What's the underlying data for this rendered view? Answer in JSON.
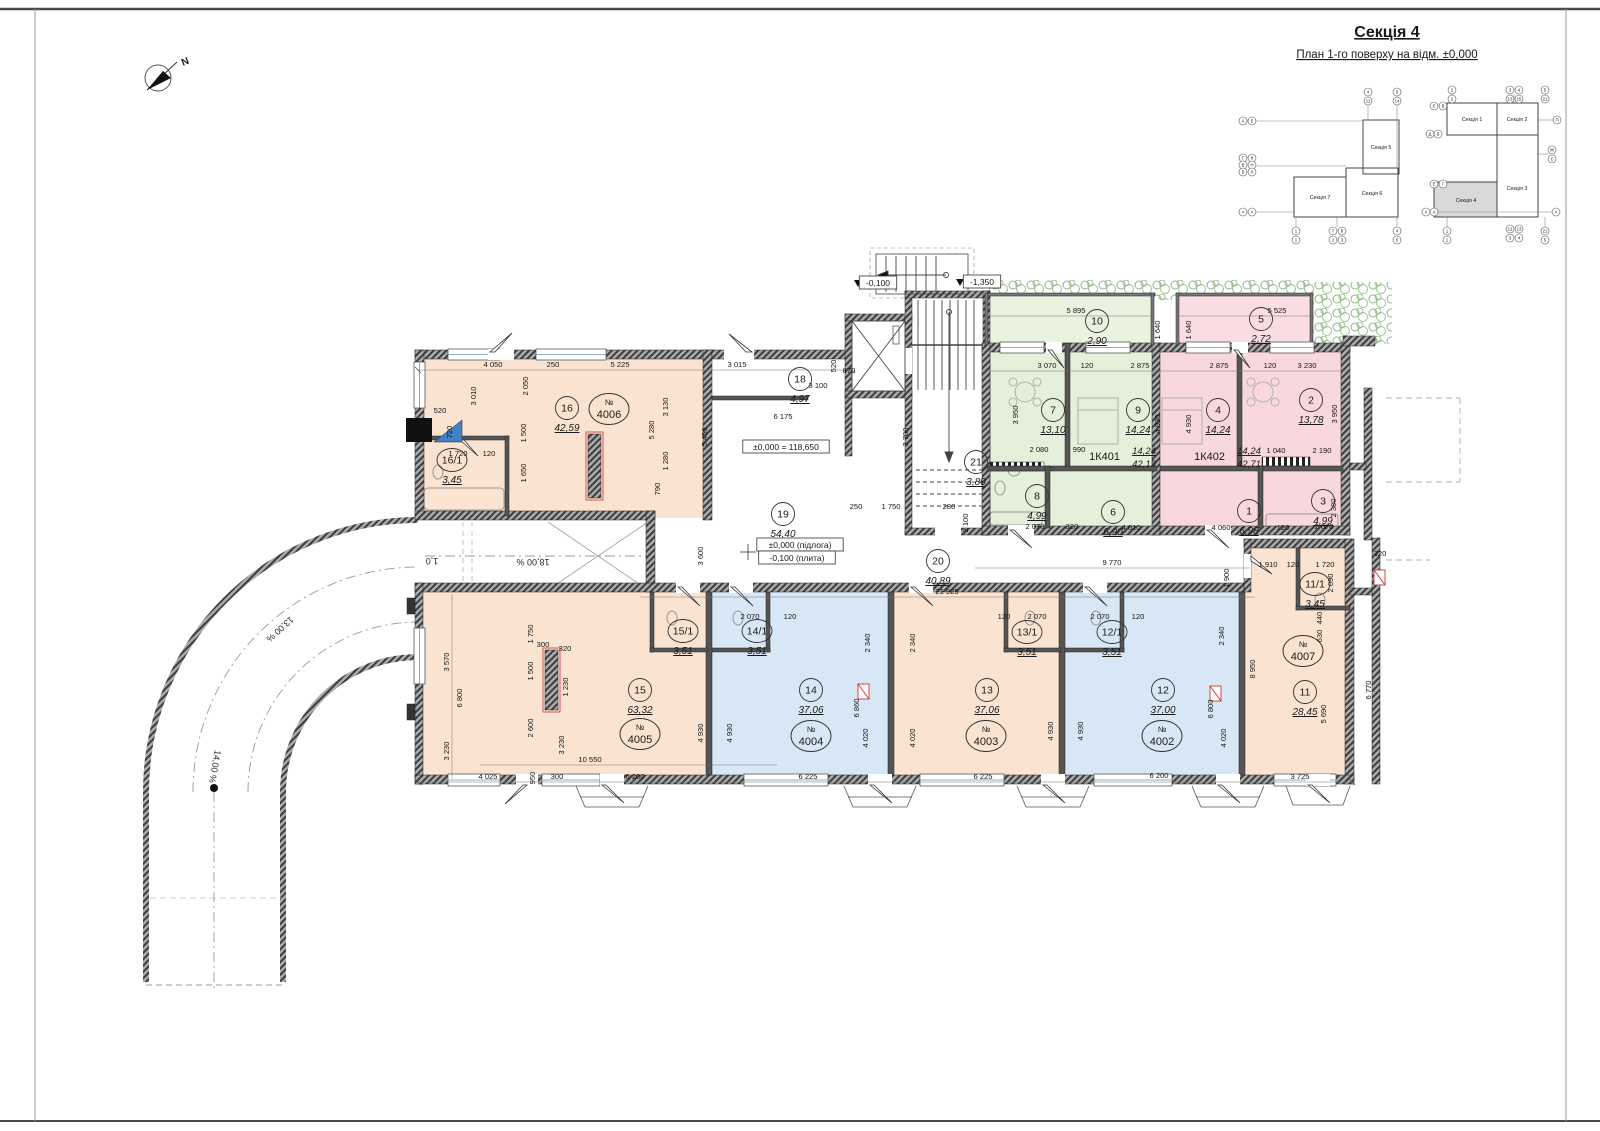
{
  "sheet": {
    "title": "Секція 4",
    "subtitle": "План 1-го поверху на відм. ±0,000"
  },
  "north": {
    "label": "N"
  },
  "key_plan": {
    "sections": [
      "Секція 5",
      "Секція 7",
      "Секція 6",
      "Секція 1",
      "Секція 2",
      "Секція 4",
      "Секція 3"
    ],
    "highlighted": "Секція 4",
    "axes": [
      [
        "А",
        1243,
        121
      ],
      [
        "Е",
        1252,
        121
      ],
      [
        "Г",
        1243,
        158
      ],
      [
        "К",
        1252,
        158
      ],
      [
        "В",
        1243,
        165
      ],
      [
        "Н",
        1252,
        165
      ],
      [
        "Б",
        1243,
        172
      ],
      [
        "Л",
        1252,
        172
      ],
      [
        "А",
        1243,
        212
      ],
      [
        "А",
        1252,
        212
      ],
      [
        "4",
        1368,
        92
      ],
      [
        "11",
        1368,
        101
      ],
      [
        "5",
        1397,
        92
      ],
      [
        "14",
        1397,
        101
      ],
      [
        "1",
        1296,
        231
      ],
      [
        "1",
        1296,
        240
      ],
      [
        "7",
        1333,
        231
      ],
      [
        "8",
        1342,
        231
      ],
      [
        "2",
        1333,
        240
      ],
      [
        "3",
        1342,
        240
      ],
      [
        "4",
        1397,
        231
      ],
      [
        "5",
        1397,
        240
      ],
      [
        "Є",
        1434,
        106
      ],
      [
        "В",
        1443,
        106
      ],
      [
        "Д",
        1430,
        134
      ],
      [
        "Б",
        1438,
        134
      ],
      [
        "Е",
        1434,
        184
      ],
      [
        "Г",
        1443,
        184
      ],
      [
        "А",
        1426,
        212
      ],
      [
        "А",
        1434,
        212
      ],
      [
        "2",
        1452,
        90
      ],
      [
        "2",
        1452,
        99
      ],
      [
        "3",
        1510,
        90
      ],
      [
        "4",
        1519,
        90
      ],
      [
        "13",
        1510,
        99
      ],
      [
        "15",
        1519,
        99
      ],
      [
        "5",
        1545,
        90
      ],
      [
        "21",
        1545,
        99
      ],
      [
        "П",
        1557,
        120
      ],
      [
        "Ж",
        1552,
        150
      ],
      [
        "Є",
        1552,
        159
      ],
      [
        "А",
        1556,
        212
      ],
      [
        "1",
        1447,
        231
      ],
      [
        "1",
        1447,
        240
      ],
      [
        "12",
        1510,
        229
      ],
      [
        "13",
        1519,
        229
      ],
      [
        "3",
        1510,
        238
      ],
      [
        "4",
        1519,
        238
      ],
      [
        "21",
        1545,
        231
      ],
      [
        "5",
        1545,
        240
      ]
    ]
  },
  "levels": [
    [
      "±0,000 = 118,650",
      786,
      447
    ],
    [
      "±0,000 (підлога)",
      800,
      545
    ],
    [
      "-0,100 (плита)",
      797,
      558
    ],
    [
      "-0,100",
      878,
      283
    ],
    [
      "-1,350",
      982,
      282
    ]
  ],
  "slopes": [
    [
      "13,00 %",
      278,
      627,
      138
    ],
    [
      "18,00 %",
      533,
      559,
      180
    ],
    [
      "1,0",
      432,
      558,
      180
    ],
    [
      "14,00 %",
      212,
      766,
      100
    ]
  ],
  "rooms": [
    [
      "16",
      "42,59",
      567,
      408
    ],
    [
      "16/1",
      "3,45",
      452,
      460
    ],
    [
      "18",
      "4,97",
      800,
      379
    ],
    [
      "19",
      "54,40",
      783,
      514
    ],
    [
      "21",
      "3,80",
      976,
      462
    ],
    [
      "20",
      "40,89",
      938,
      561
    ],
    [
      "10",
      "2,90",
      1097,
      321
    ],
    [
      "7",
      "13,10",
      1053,
      410
    ],
    [
      "9",
      "14,24",
      1138,
      410
    ],
    [
      "8",
      "4,99",
      1037,
      496
    ],
    [
      "6",
      "6,90",
      1113,
      512
    ],
    [
      "5",
      "2,72",
      1261,
      319
    ],
    [
      "4",
      "14,24",
      1218,
      410
    ],
    [
      "2",
      "13,78",
      1311,
      400
    ],
    [
      "1",
      "6,98",
      1249,
      511
    ],
    [
      "3",
      "4,99",
      1323,
      501
    ],
    [
      "15",
      "63,32",
      640,
      690
    ],
    [
      "15/1",
      "3,51",
      683,
      631
    ],
    [
      "14/1",
      "3,51",
      757,
      631
    ],
    [
      "14",
      "37,06",
      811,
      690
    ],
    [
      "13/1",
      "3,51",
      1027,
      632
    ],
    [
      "13",
      "37,06",
      987,
      690
    ],
    [
      "12/1",
      "3,51",
      1112,
      632
    ],
    [
      "12",
      "37,00",
      1163,
      690
    ],
    [
      "11/1",
      "3,45",
      1315,
      584
    ],
    [
      "11",
      "28,45",
      1305,
      692
    ]
  ],
  "units": [
    [
      "4006",
      609,
      409
    ],
    [
      "4005",
      640,
      734
    ],
    [
      "4004",
      811,
      736
    ],
    [
      "4003",
      986,
      736
    ],
    [
      "4002",
      1162,
      736
    ],
    [
      "4007",
      1303,
      651
    ]
  ],
  "apartments": [
    [
      "1К401",
      "14,24",
      "42,13",
      1120,
      460
    ],
    [
      "1К402",
      "14,24",
      "42,71",
      1225,
      460
    ]
  ],
  "dims": [
    [
      "4 050",
      493,
      367,
      0
    ],
    [
      "250",
      553,
      367,
      0
    ],
    [
      "5 225",
      620,
      367,
      0
    ],
    [
      "3 015",
      737,
      367,
      0
    ],
    [
      "3 100",
      818,
      388,
      0
    ],
    [
      "870",
      849,
      373,
      0
    ],
    [
      "520",
      836,
      366,
      -90
    ],
    [
      "6 175",
      783,
      419,
      0
    ],
    [
      "5 450",
      707,
      437,
      -90
    ],
    [
      "3 010",
      476,
      396,
      -90
    ],
    [
      "2 050",
      528,
      386,
      -90
    ],
    [
      "1 500",
      526,
      433,
      -90
    ],
    [
      "1 650",
      526,
      473,
      -90
    ],
    [
      "520",
      440,
      413,
      0
    ],
    [
      "720",
      452,
      432,
      -90
    ],
    [
      "1 720",
      458,
      456,
      0
    ],
    [
      "120",
      489,
      456,
      0
    ],
    [
      "5 280",
      654,
      430,
      -90
    ],
    [
      "3 130",
      668,
      407,
      -90
    ],
    [
      "1 280",
      668,
      461,
      -90
    ],
    [
      "790",
      660,
      489,
      -90
    ],
    [
      "3 700",
      908,
      437,
      -90
    ],
    [
      "3 600",
      703,
      556,
      -90
    ],
    [
      "250",
      856,
      509,
      0
    ],
    [
      "1 750",
      891,
      509,
      0
    ],
    [
      "280",
      949,
      509,
      0
    ],
    [
      "2 100",
      968,
      523,
      -90
    ],
    [
      "21 925",
      947,
      594,
      0
    ],
    [
      "9 770",
      1112,
      565,
      0
    ],
    [
      "1 900",
      1229,
      578,
      -90
    ],
    [
      "1 910",
      1268,
      567,
      0
    ],
    [
      "120",
      1293,
      567,
      0
    ],
    [
      "1 720",
      1325,
      567,
      0
    ],
    [
      "2 090",
      1333,
      583,
      -90
    ],
    [
      "320",
      1380,
      556,
      0
    ],
    [
      "5 895",
      1076,
      313,
      0
    ],
    [
      "1 640",
      1160,
      330,
      -90
    ],
    [
      "1 640",
      1191,
      330,
      -90
    ],
    [
      "3 070",
      1047,
      368,
      0
    ],
    [
      "120",
      1087,
      368,
      0
    ],
    [
      "2 875",
      1140,
      368,
      0
    ],
    [
      "3 950",
      1018,
      415,
      -90
    ],
    [
      "4 930",
      1160,
      424,
      -90
    ],
    [
      "4 930",
      1191,
      424,
      -90
    ],
    [
      "2 080",
      1039,
      452,
      0
    ],
    [
      "990",
      1079,
      452,
      0
    ],
    [
      "2 070",
      1035,
      529,
      0
    ],
    [
      "320",
      1072,
      529,
      0
    ],
    [
      "4 010",
      1131,
      530,
      0
    ],
    [
      "5 525",
      1277,
      313,
      0
    ],
    [
      "2 875",
      1219,
      368,
      0
    ],
    [
      "120",
      1270,
      368,
      0
    ],
    [
      "3 230",
      1307,
      368,
      0
    ],
    [
      "3 950",
      1337,
      414,
      -90
    ],
    [
      "1 040",
      1276,
      453,
      0
    ],
    [
      "2 190",
      1322,
      453,
      0
    ],
    [
      "4 060",
      1221,
      530,
      0
    ],
    [
      "120",
      1283,
      530,
      0
    ],
    [
      "2 070",
      1324,
      529,
      0
    ],
    [
      "2 380",
      1336,
      508,
      -90
    ],
    [
      "440",
      1322,
      618,
      -90
    ],
    [
      "630",
      1322,
      636,
      -90
    ],
    [
      "8 950",
      1255,
      669,
      -90
    ],
    [
      "5 690",
      1326,
      714,
      -90
    ],
    [
      "6 770",
      1371,
      690,
      -90
    ],
    [
      "2 070",
      750,
      619,
      0
    ],
    [
      "120",
      790,
      619,
      0
    ],
    [
      "120",
      1004,
      619,
      0
    ],
    [
      "2 070",
      1037,
      619,
      0
    ],
    [
      "2 070",
      1100,
      619,
      0
    ],
    [
      "120",
      1138,
      619,
      0
    ],
    [
      "2 340",
      870,
      643,
      -90
    ],
    [
      "2 340",
      915,
      643,
      -90
    ],
    [
      "2 340",
      1224,
      636,
      -90
    ],
    [
      "6 860",
      859,
      708,
      -90
    ],
    [
      "6 800",
      1213,
      709,
      -90
    ],
    [
      "4 020",
      868,
      738,
      -90
    ],
    [
      "4 020",
      915,
      738,
      -90
    ],
    [
      "4 020",
      1226,
      738,
      -90
    ],
    [
      "4 930",
      703,
      733,
      -90
    ],
    [
      "4 930",
      732,
      733,
      -90
    ],
    [
      "4 930",
      1053,
      731,
      -90
    ],
    [
      "4 930",
      1083,
      731,
      -90
    ],
    [
      "3 570",
      449,
      662,
      -90
    ],
    [
      "6 800",
      462,
      698,
      -90
    ],
    [
      "3 230",
      449,
      751,
      -90
    ],
    [
      "1 750",
      533,
      634,
      -90
    ],
    [
      "300",
      543,
      647,
      0
    ],
    [
      "320",
      565,
      651,
      0
    ],
    [
      "1 500",
      533,
      671,
      -90
    ],
    [
      "1 230",
      568,
      687,
      -90
    ],
    [
      "2 600",
      533,
      728,
      -90
    ],
    [
      "3 230",
      564,
      745,
      -90
    ],
    [
      "10 550",
      590,
      762,
      0
    ],
    [
      "4 025",
      488,
      779,
      0
    ],
    [
      "950",
      535,
      778,
      -90
    ],
    [
      "300",
      557,
      779,
      0
    ],
    [
      "6 200",
      635,
      779,
      0
    ],
    [
      "6 225",
      808,
      779,
      0
    ],
    [
      "6 225",
      983,
      779,
      0
    ],
    [
      "6 200",
      1159,
      778,
      0
    ],
    [
      "3 725",
      1300,
      779,
      0
    ]
  ]
}
